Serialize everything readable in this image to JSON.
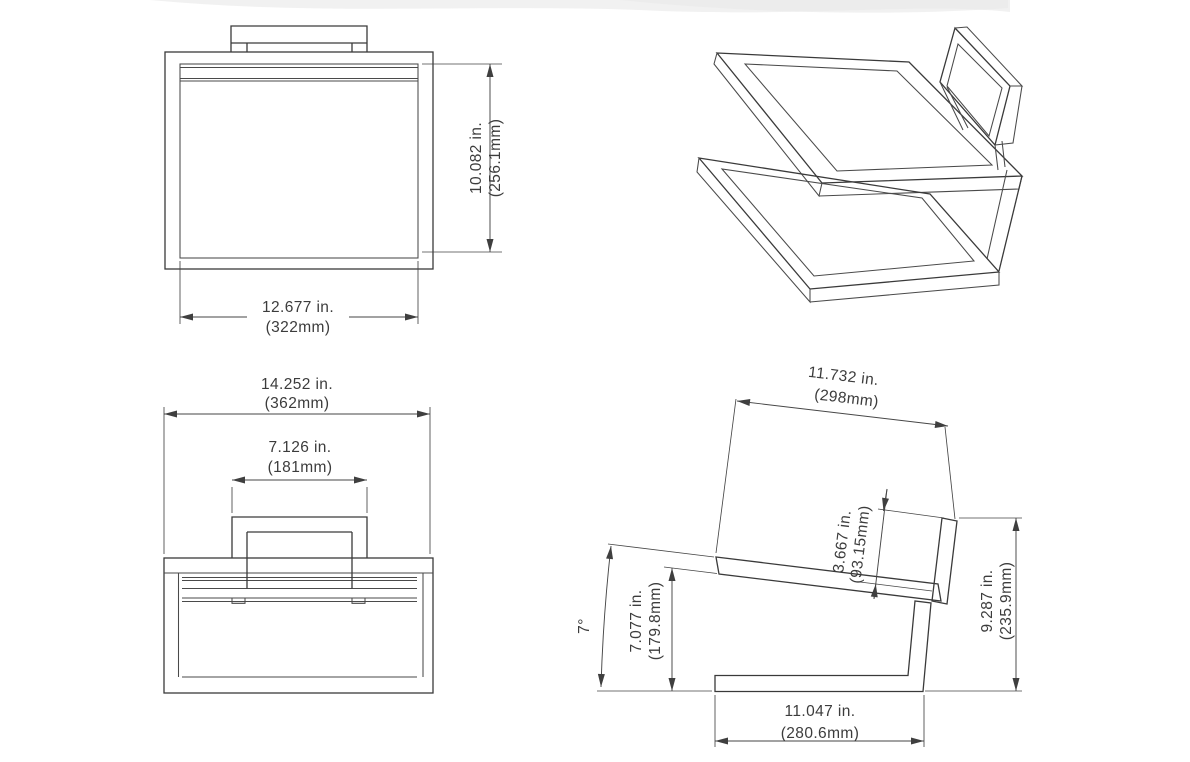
{
  "page": {
    "background": "#ffffff",
    "line_color": "#3a3a3a",
    "description": "Four-view dimensioned technical drawing of a cantilever chair frame"
  },
  "dimensions": {
    "front_height": {
      "inches": "10.082 in.",
      "millimeters": "(256.1mm)"
    },
    "front_width": {
      "inches": "12.677 in.",
      "millimeters": "(322mm)"
    },
    "plan_overall_width": {
      "inches": "14.252 in.",
      "millimeters": "(362mm)"
    },
    "plan_backrest_width": {
      "inches": "7.126 in.",
      "millimeters": "(181mm)"
    },
    "side_seat_back_length": {
      "inches": "11.732 in.",
      "millimeters": "(298mm)"
    },
    "side_backrest_height": {
      "inches": "3.667 in.",
      "millimeters": "(93.15mm)"
    },
    "side_tilt_angle": "7°",
    "side_front_height": {
      "inches": "7.077 in.",
      "millimeters": "(179.8mm)"
    },
    "side_overall_height": {
      "inches": "9.287 in.",
      "millimeters": "(235.9mm)"
    },
    "side_base_length": {
      "inches": "11.047 in.",
      "millimeters": "(280.6mm)"
    }
  }
}
